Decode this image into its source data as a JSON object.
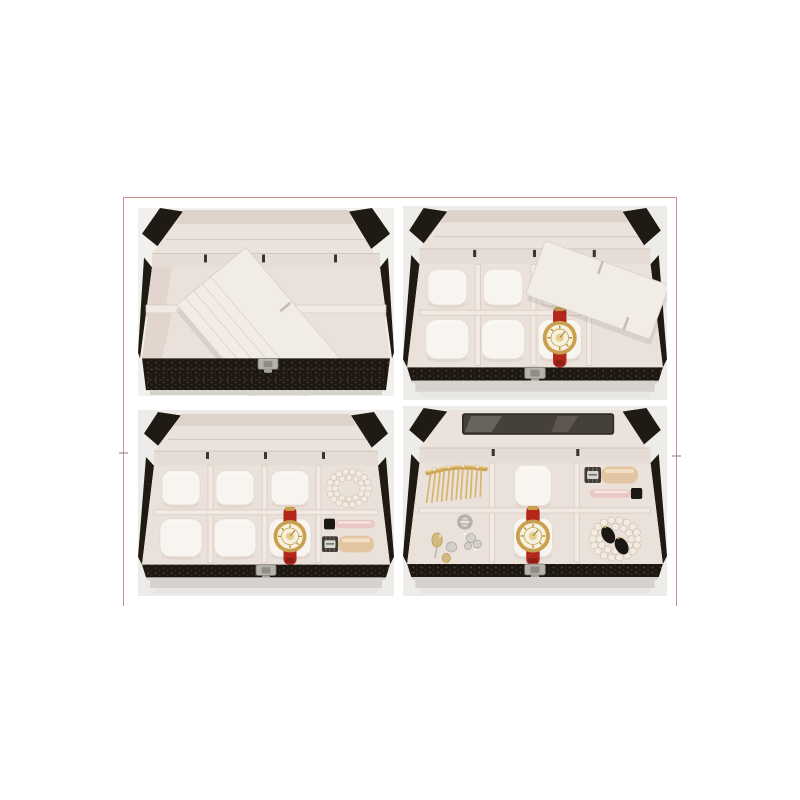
{
  "page": {
    "background": "#ffffff"
  },
  "collage": {
    "alt": "Four product photos of a black crocodile-pattern leather jewelry and watch storage box shown open with accessories inside",
    "frame_color": "#c99086"
  },
  "panels": [
    {
      "id": "top-left",
      "alt": "Open empty jewelry box with five removable white divider cards fanned across the interior",
      "items": [
        "jewelry-box",
        "divider-cards",
        "shelf-divider",
        "metal-clasp"
      ]
    },
    {
      "id": "top-right",
      "alt": "Jewelry box tray with six white watch pillows, a gold watch with red strap and a loose white divider card laid diagonally",
      "items": [
        "jewelry-box",
        "watch-pillows",
        "red-strap-watch",
        "divider-card",
        "metal-clasp"
      ]
    },
    {
      "id": "bottom-left",
      "alt": "Jewelry box tray with watch pillows, a gold watch with red strap, a pearl bracelet, a lip gloss and a nail polish bottle",
      "items": [
        "jewelry-box",
        "watch-pillows",
        "red-strap-watch",
        "pearl-bracelet",
        "lip-gloss",
        "nail-polish",
        "metal-clasp"
      ]
    },
    {
      "id": "bottom-right",
      "alt": "Jewelry box tray holding a gold hair comb, earrings, a ring, a gold watch with red strap, a pearl bracelet with black oval earrings, nail polish and lip gloss",
      "items": [
        "jewelry-box",
        "lid-mirror",
        "gold-hair-comb",
        "earrings",
        "ring",
        "red-strap-watch",
        "pearl-bracelet",
        "black-earrings",
        "nail-polish",
        "lip-gloss",
        "metal-clasp"
      ]
    }
  ],
  "palette": {
    "frame": "#c99086",
    "photo-bg": "#eeece9",
    "box-dark": "#201a15",
    "lid-cream": "#eae2db",
    "lid-band": "#ddd3cb",
    "wall-cream": "#e5dcd5",
    "floor-cream": "#eae1da",
    "divider": "#f1e9e2",
    "pillow": "#f8f4ef",
    "card": "#f2ece7",
    "strap-red": "#b3271c",
    "gold": "#c9a14e",
    "gold-light": "#e6cf8e",
    "dial": "#f6f0df",
    "silver": "#b6b3ad",
    "pearl": "#f3ebe1",
    "gloss-pink": "#e9c8c3",
    "cap-black": "#1b1713",
    "champagne": "#e2c6a2",
    "shadow": "#d6d3cf"
  }
}
